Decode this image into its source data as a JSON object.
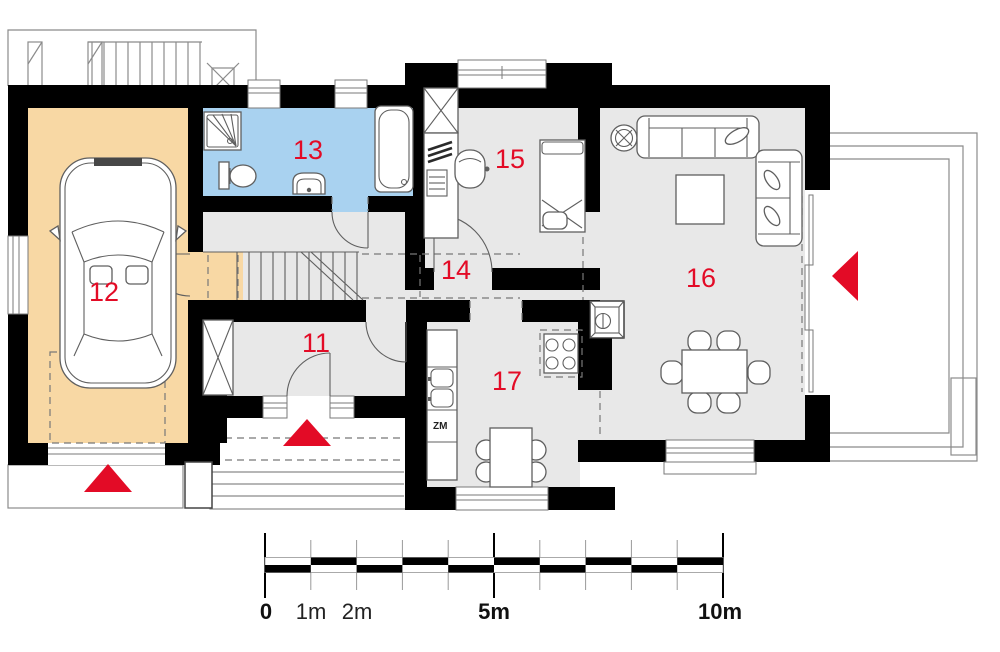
{
  "page": {
    "type": "architectural ground-floor plan"
  },
  "rooms": [
    {
      "key": "vestibule",
      "label": "11"
    },
    {
      "key": "garage",
      "label": "12"
    },
    {
      "key": "bathroom",
      "label": "13"
    },
    {
      "key": "hallway",
      "label": "14"
    },
    {
      "key": "bedroom-office",
      "label": "15"
    },
    {
      "key": "living-room",
      "label": "16"
    },
    {
      "key": "kitchen",
      "label": "17"
    }
  ],
  "annotations": {
    "dishwasher_label": "ZM"
  },
  "entrance_arrows": {
    "count": 3,
    "color": "#e30b26"
  },
  "scale_bar": {
    "labels": [
      "0",
      "1m",
      "2m",
      "5m",
      "10m"
    ]
  },
  "colors": {
    "wall": "#000000",
    "garage_floor": "#f8d8a4",
    "bathroom_floor": "#a9d2f0",
    "room_floor": "#e8e8e8",
    "accent_red": "#e30b26",
    "outline_gray": "#8b8b8b"
  },
  "icons": [
    "car-icon",
    "bathtub-icon",
    "shower-icon",
    "toilet-icon",
    "sink-icon",
    "bed-icon",
    "desk-icon",
    "office-chair-icon",
    "wardrobe-icon",
    "sofa-icon",
    "couch-icon",
    "coffee-table-icon",
    "dining-table-icon",
    "kitchen-table-icon",
    "stove-icon",
    "fireplace-icon",
    "plant-icon",
    "stairs-icon",
    "kitchen-sink-icon",
    "entrance-arrow-icon",
    "skylight-icon"
  ]
}
